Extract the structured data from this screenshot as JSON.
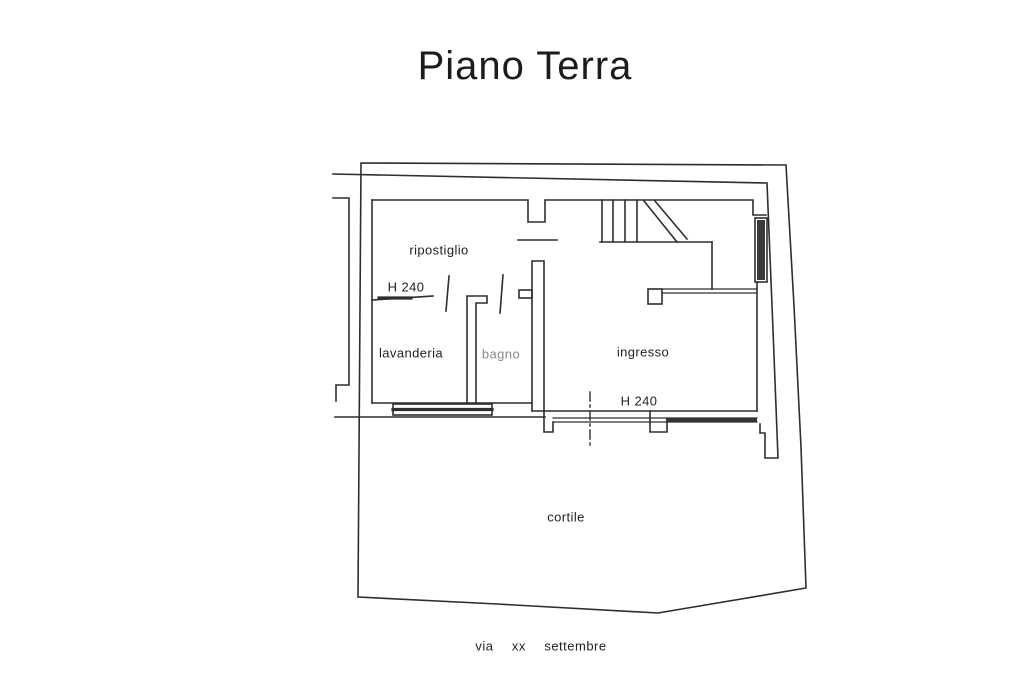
{
  "title": "Piano Terra",
  "street_label": "via xx settembre",
  "rooms": [
    {
      "id": "ripostiglio",
      "label": "ripostiglio"
    },
    {
      "id": "lavanderia",
      "label": "lavanderia"
    },
    {
      "id": "bagno",
      "label": "bagno"
    },
    {
      "id": "ingresso",
      "label": "ingresso"
    },
    {
      "id": "cortile",
      "label": "cortile"
    }
  ],
  "annotations": [
    {
      "id": "h240-ripostiglio",
      "label": "H 240"
    },
    {
      "id": "h240-ingresso",
      "label": "H 240"
    }
  ],
  "features": [
    "staircase",
    "entry-door-axis",
    "windows",
    "courtyard-boundary"
  ],
  "colors": {
    "line": "#2e2e2e",
    "text": "#1f1f1f",
    "muted_text": "#8a8a8a",
    "window_fill": "#3a3a3a",
    "background": "#ffffff"
  }
}
